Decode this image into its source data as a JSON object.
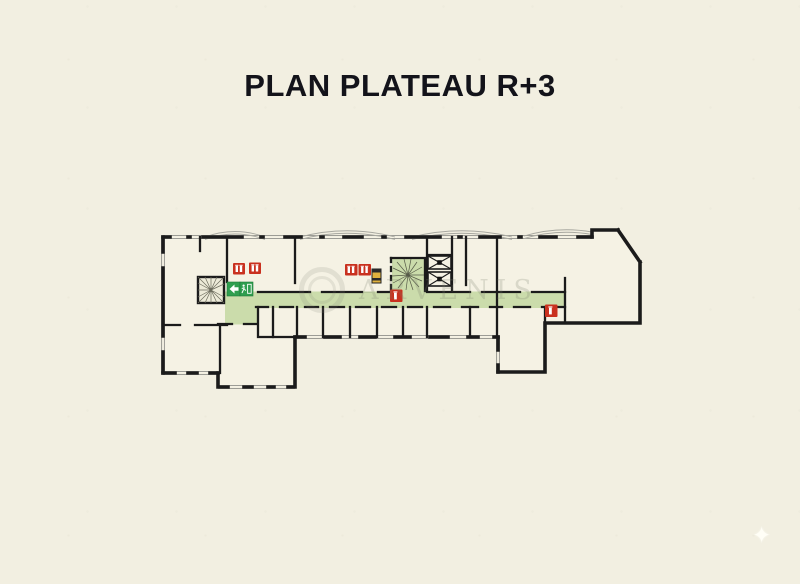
{
  "title": {
    "text": "PLAN PLATEAU R+3"
  },
  "watermark": {
    "text": "ARVENIS",
    "logo": "double-circle-logo"
  },
  "decor": {
    "sparkle_glyph": "✦"
  },
  "plan": {
    "label": "floor-plan-level-R+3",
    "colors": {
      "background": "#f2efe1",
      "wall_black": "#1b1b1b",
      "corridor_green": "#cbdcab",
      "exit_sign_green": "#2f9e4f",
      "safety_sign_red": "#c9311f",
      "electrical_panel_yellow": "#e0b23e",
      "window_line_gray": "#90908a"
    },
    "icons": [
      {
        "name": "exit-left-arrow-icon",
        "glyph": "◀",
        "meaning": "evacuation direction sign"
      },
      {
        "name": "emergency-exit-icon",
        "meaning": "running-man emergency exit sign"
      },
      {
        "name": "fire-safety-sign-icon",
        "meaning": "red fire-safety equipment sign",
        "count": 6
      },
      {
        "name": "stairs-icon",
        "meaning": "left staircase with radial treads"
      },
      {
        "name": "spiral-stairs-icon",
        "meaning": "central spiral staircase"
      },
      {
        "name": "elevator-icon",
        "meaning": "elevator shaft with X cross",
        "count": 2
      },
      {
        "name": "electrical-panel-icon",
        "meaning": "technical riser panel"
      },
      {
        "name": "sparkle-icon",
        "meaning": "decorative sparkle bottom-right"
      }
    ],
    "features": [
      "outer walls with window openings and bay-window arcs on top facade",
      "green evacuation corridor running east-west",
      "row of small rooms south of corridor",
      "two elevator shafts beside spiral staircase core",
      "chamfered building corner on the east end"
    ]
  }
}
